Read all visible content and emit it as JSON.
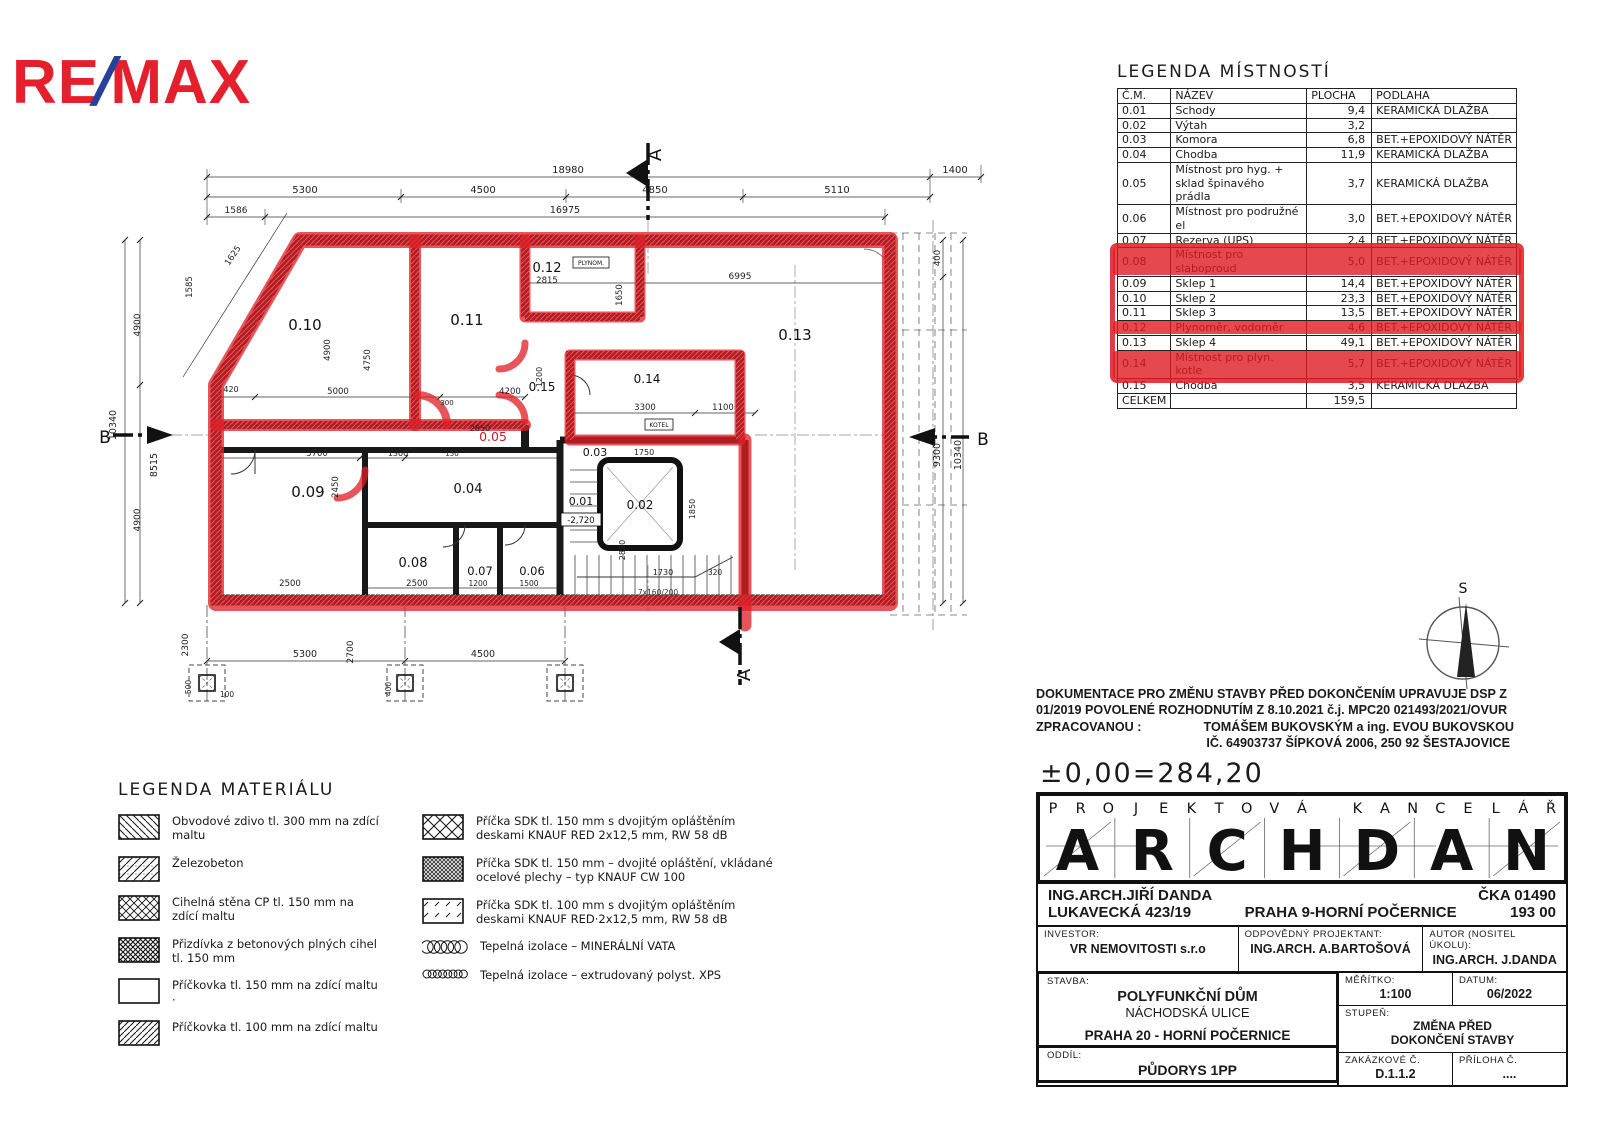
{
  "branding": {
    "re": "RE",
    "slash": "/",
    "max": "MAX"
  },
  "colors": {
    "marker_red": "#df2027",
    "remax_red": "#e4202c",
    "remax_blue": "#27409b"
  },
  "room_legend": {
    "title": "LEGENDA MÍSTNOSTÍ",
    "headers": [
      "Č.M.",
      "NÁZEV",
      "PLOCHA",
      "PODLAHA"
    ],
    "rows": [
      {
        "cm": "0.01",
        "nazev": "Schody",
        "plocha": "9,4",
        "podlaha": "KERAMICKÁ DLAŽBA"
      },
      {
        "cm": "0.02",
        "nazev": "Výtah",
        "plocha": "3,2",
        "podlaha": ""
      },
      {
        "cm": "0.03",
        "nazev": "Komora",
        "plocha": "6,8",
        "podlaha": "BET.+EPOXIDOVÝ NÁTĚR"
      },
      {
        "cm": "0.04",
        "nazev": "Chodba",
        "plocha": "11,9",
        "podlaha": "KERAMICKÁ DLAŽBA"
      },
      {
        "cm": "0.05",
        "nazev": "Místnost pro hyg. + sklad špinavého prádla",
        "plocha": "3,7",
        "podlaha": "KERAMICKÁ DLAŽBA"
      },
      {
        "cm": "0.06",
        "nazev": "Místnost pro podružné el",
        "plocha": "3,0",
        "podlaha": "BET.+EPOXIDOVÝ NÁTĚR"
      },
      {
        "cm": "0.07",
        "nazev": "Rezerva (UPS)",
        "plocha": "2,4",
        "podlaha": "BET.+EPOXIDOVÝ NÁTĚR"
      },
      {
        "cm": "0.08",
        "nazev": "Místnost pro slaboproud",
        "plocha": "5,0",
        "podlaha": "BET.+EPOXIDOVÝ NÁTĚR"
      },
      {
        "cm": "0.09",
        "nazev": "Sklep 1",
        "plocha": "14,4",
        "podlaha": "BET.+EPOXIDOVÝ NÁTĚR"
      },
      {
        "cm": "0.10",
        "nazev": "Sklep 2",
        "plocha": "23,3",
        "podlaha": "BET.+EPOXIDOVÝ NÁTĚR"
      },
      {
        "cm": "0.11",
        "nazev": "Sklep 3",
        "plocha": "13,5",
        "podlaha": "BET.+EPOXIDOVÝ NÁTĚR"
      },
      {
        "cm": "0.12",
        "nazev": "Plynoměr, vodoměr",
        "plocha": "4,6",
        "podlaha": "BET.+EPOXIDOVÝ NÁTĚR"
      },
      {
        "cm": "0.13",
        "nazev": "Sklep 4",
        "plocha": "49,1",
        "podlaha": "BET.+EPOXIDOVÝ NÁTĚR"
      },
      {
        "cm": "0.14",
        "nazev": "Místnost pro plyn. kotle",
        "plocha": "5,7",
        "podlaha": "BET.+EPOXIDOVÝ NÁTĚR"
      },
      {
        "cm": "0.15",
        "nazev": "Chodba",
        "plocha": "3,5",
        "podlaha": "KERAMICKÁ DLAŽBA"
      }
    ],
    "total_label": "CELKEM",
    "total_value": "159,5",
    "highlight": {
      "from": "0.08",
      "to": "0.14",
      "struck": [
        "0.08",
        "0.12",
        "0.14"
      ]
    }
  },
  "plan": {
    "rooms": [
      "0.10",
      "0.11",
      "0.12",
      "0.13",
      "0.14",
      "0.15",
      "0.05",
      "0.09",
      "0.04",
      "0.08",
      "0.07",
      "0.06",
      "0.03",
      "0.01",
      "0.02"
    ],
    "small_labels": {
      "plynom": "PLYNOM.",
      "kotel": "KOTEL",
      "level": "-2,720",
      "stairs": "7x160/200"
    },
    "sections": {
      "a": "A",
      "b": "B"
    },
    "compass_north": "S",
    "dims": {
      "t_total": "18980",
      "t1": "5300",
      "t2": "4500",
      "t3": "4850",
      "t4": "5110",
      "t5": "1400",
      "t6": "16975",
      "t7": "1586",
      "l1": "1585",
      "l2": "1625",
      "l3": "10340",
      "l4": "8515",
      "l5": "4900",
      "l5b": "4900",
      "l6": "2300",
      "l7": "2700",
      "l8": "420",
      "r1": "400",
      "r2": "9300",
      "r3": "10340",
      "b1": "5300",
      "b2": "4500",
      "b3": "500",
      "b4": "100",
      "b5": "400",
      "i2815": "2815",
      "i6995": "6995",
      "i3300": "3300",
      "i1100": "1100",
      "i3700": "3700",
      "i2500a": "2500",
      "i2500b": "2500",
      "i1200b": "1200",
      "i1500": "1500",
      "i5000": "5000",
      "i4200": "4200",
      "i300": "300",
      "i4900": "4900",
      "i4750": "4750",
      "i2450": "2450",
      "i1650": "1650",
      "i1200": "1200",
      "i1730": "1730",
      "i320": "320",
      "i2850": "2850",
      "i2850b": "2850",
      "i1300": "1300",
      "i150": "150",
      "i1750": "1750",
      "i1850": "1850"
    }
  },
  "material_legend": {
    "title": "LEGENDA MATERIÁLU",
    "left": [
      {
        "pattern": "pat-back",
        "text": "Obvodové zdivo tl. 300 mm na zdící maltu"
      },
      {
        "pattern": "pat-slash",
        "text": "Železobeton"
      },
      {
        "pattern": "pat-cross",
        "text": "Cihelná stěna CP tl. 150 mm na zdící maltu"
      },
      {
        "pattern": "pat-dense",
        "text": "Přizdívka z betonových plných cihel tl. 150 mm"
      },
      {
        "pattern": "pat-none",
        "text": "Příčkovka tl. 150 mm na zdící maltu ·"
      },
      {
        "pattern": "pat-slash2",
        "text": "Příčkovka tl. 100 mm na zdící maltu"
      }
    ],
    "right": [
      {
        "pattern": "pat-cross-big",
        "text": "Příčka SDK tl. 150 mm s dvojitým opláštěním deskami KNAUF RED 2x12,5 mm, RW 58 dB"
      },
      {
        "pattern": "pat-steel",
        "text": "Příčka SDK tl. 150 mm – dvojité opláštění, vkládané ocelové plechy – typ KNAUF CW 100"
      },
      {
        "pattern": "pat-dash",
        "text": "Příčka SDK tl. 100 mm s dvojitým opláštěním deskami KNAUF RED·2x12,5 mm, RW 58 dB"
      },
      {
        "pattern": "loops",
        "text": "Tepelná izolace – MINERÁLNÍ VATA"
      },
      {
        "pattern": "loops-small",
        "text": "Tepelná izolace – extrudovaný polyst. XPS"
      }
    ]
  },
  "doc_note": {
    "l1": "DOKUMENTACE PRO ZMĚNU STAVBY PŘED DOKONČENÍM UPRAVUJE DSP Z",
    "l2": "01/2019 POVOLENÉ ROZHODNUTÍM Z 8.10.2021 č.j. MPC20 021493/2021/OVUR",
    "l3a": "ZPRACOVANOU :",
    "l3b": "TOMÁŠEM BUKOVSKÝM a ing. EVOU BUKOVSKOU",
    "l4": "IČ. 64903737  ŠÍPKOVÁ 2006, 250 92 ŠESTAJOVICE"
  },
  "level_mark": "±0,00=284,20",
  "title_block": {
    "office_small": "PROJEKTOVÁ KANCELÁŘ",
    "office_big": "ARCHDAN",
    "architect": "ING.ARCH.JIŘÍ DANDA",
    "cka": "ČKA 01490",
    "street": "LUKAVECKÁ 423/19",
    "city": "PRAHA 9-HORNÍ POČERNICE",
    "zip": "193 00",
    "investor_label": "INVESTOR:",
    "investor": "VR NEMOVITOSTI s.r.o",
    "designer_label": "ODPOVĚDNÝ PROJEKTANT:",
    "designer": "ING.ARCH. A.BARTOŠOVÁ",
    "author_label": "AUTOR (NOSITEL ÚKOLU):",
    "author": "ING.ARCH. J.DANDA",
    "stavba_label": "STAVBA:",
    "stavba1": "POLYFUNKČNÍ DŮM",
    "stavba2": "NÁCHODSKÁ ULICE",
    "stavba3": "PRAHA 20 - HORNÍ POČERNICE",
    "oddil_label": "ODDÍL:",
    "oddil": "PŮDORYS 1PP",
    "meritko_label": "MĚŘÍTKO:",
    "meritko": "1:100",
    "datum_label": "DATUM:",
    "datum": "06/2022",
    "stupen_label": "STUPEŇ:",
    "stupen1": "ZMĚNA PŘED",
    "stupen2": "DOKONČENÍ STAVBY",
    "zakazka_label": "ZAKÁZKOVÉ Č.",
    "zakazka": "D.1.1.2",
    "priloha_label": "PŘÍLOHA Č.",
    "priloha": "...."
  }
}
